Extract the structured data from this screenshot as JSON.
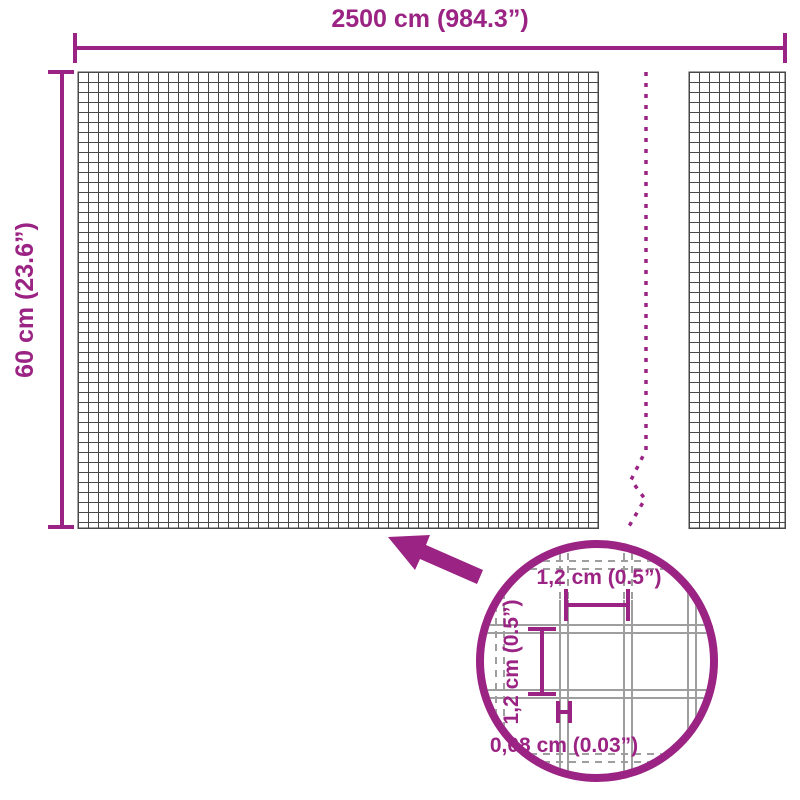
{
  "diagram": {
    "overall": {
      "width_label": "2500 cm (984.3”)",
      "height_label": "60 cm (23.6”)"
    },
    "detail_view": {
      "opening_width_label": "1,2 cm (0.5”)",
      "opening_height_label": "1,2 cm (0.5”)",
      "wire_thickness_label": "0,08 cm (0.03”)"
    },
    "colors": {
      "accent": "#9A2383",
      "mesh_grid": "#474747",
      "detail_wire": "#9E9E9E",
      "background": "#FFFFFF"
    }
  }
}
